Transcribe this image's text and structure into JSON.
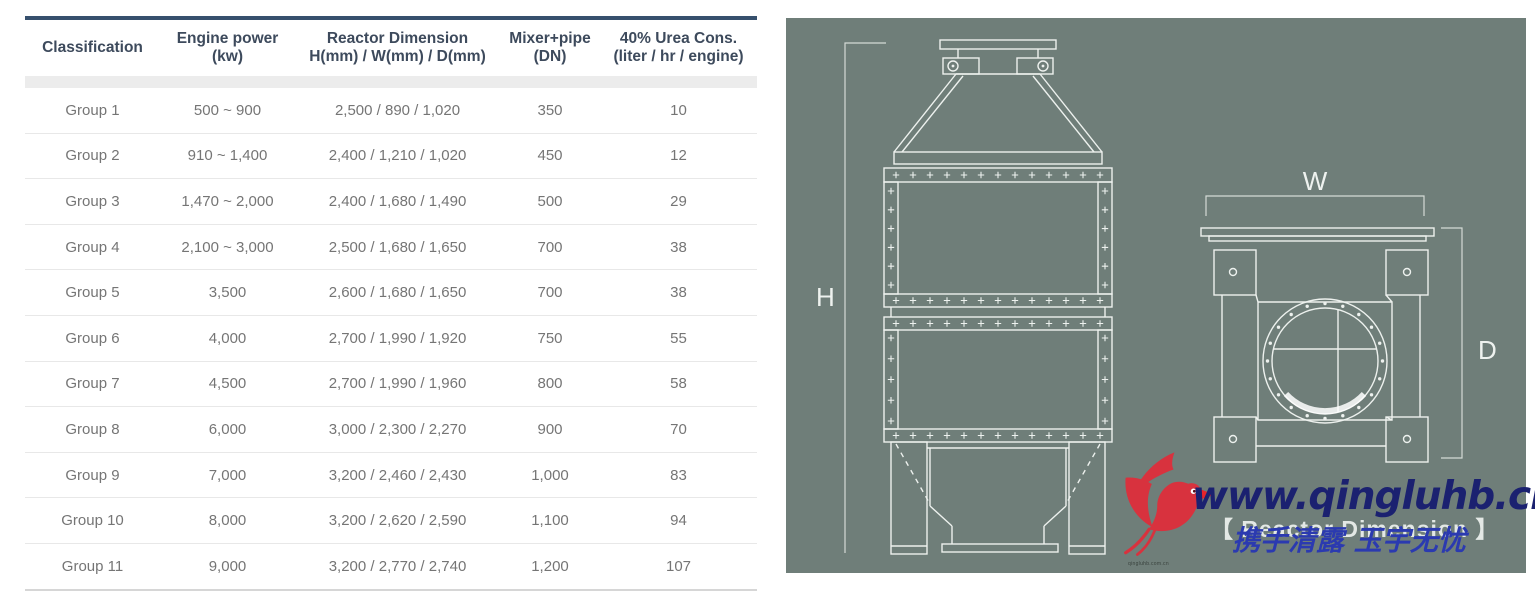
{
  "colors": {
    "bar": "#36506d",
    "panelbg": "#6f7e79",
    "line": "#edf1ee",
    "site": "#1b2170",
    "slogan": "#2b3ab0",
    "bird": "#d8323e",
    "headtext": "#3d4a5c",
    "bodytext": "#757575"
  },
  "table": {
    "columns": [
      {
        "line1": "Classification",
        "line2": ""
      },
      {
        "line1": "Engine power",
        "line2": "(kw)"
      },
      {
        "line1": "Reactor Dimension",
        "line2": "H(mm) / W(mm) / D(mm)"
      },
      {
        "line1": "Mixer+pipe",
        "line2": "(DN)"
      },
      {
        "line1": "40% Urea Cons.",
        "line2": "(liter / hr / engine)"
      }
    ],
    "rows": [
      [
        "Group 1",
        "500 ~ 900",
        "2,500 / 890 / 1,020",
        "350",
        "10"
      ],
      [
        "Group 2",
        "910 ~ 1,400",
        "2,400 / 1,210 / 1,020",
        "450",
        "12"
      ],
      [
        "Group 3",
        "1,470 ~ 2,000",
        "2,400 / 1,680 / 1,490",
        "500",
        "29"
      ],
      [
        "Group 4",
        "2,100 ~ 3,000",
        "2,500 / 1,680 / 1,650",
        "700",
        "38"
      ],
      [
        "Group 5",
        "3,500",
        "2,600 / 1,680 / 1,650",
        "700",
        "38"
      ],
      [
        "Group 6",
        "4,000",
        "2,700 / 1,990 / 1,920",
        "750",
        "55"
      ],
      [
        "Group 7",
        "4,500",
        "2,700 / 1,990 / 1,960",
        "800",
        "58"
      ],
      [
        "Group 8",
        "6,000",
        "3,000 / 2,300 / 2,270",
        "900",
        "70"
      ],
      [
        "Group 9",
        "7,000",
        "3,200 / 2,460 / 2,430",
        "1,000",
        "83"
      ],
      [
        "Group 10",
        "8,000",
        "3,200 / 2,620 / 2,590",
        "1,100",
        "94"
      ],
      [
        "Group 11",
        "9,000",
        "3,200 / 2,770 / 2,740",
        "1,200",
        "107"
      ]
    ]
  },
  "diagram": {
    "labels": {
      "height": "H",
      "width": "W",
      "depth": "D"
    }
  },
  "watermark": {
    "site": "www.qingluhb.cn",
    "caption": "【 Reactor Dimension 】",
    "slogan": "携手清露 玉宇无忧",
    "tiny_text": "qingluhb.com.cn"
  }
}
